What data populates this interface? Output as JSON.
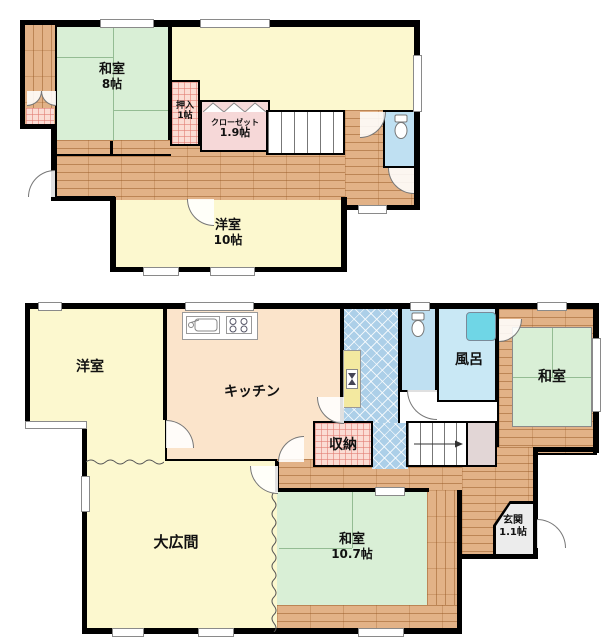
{
  "document_type": "floor-plan",
  "colors": {
    "wall": "#000000",
    "tatami_green": "#d9efd6",
    "western_room_yellow": "#fcf8cf",
    "kitchen_peach": "#fbe4cb",
    "wood_floor": "#e2b287",
    "closet_pink": "#f6d8d8",
    "closet_hatch_pink": "#fbdcd4",
    "toilet_blue": "#bfe0f2",
    "bath_blue": "#c9e8f5",
    "washroom_tile_blue": "#accfe8",
    "bathtub_cyan": "#6fd6e6",
    "entrance_grey": "#ececec",
    "understairs_grey": "#e2d6d6"
  },
  "floor1": {
    "rooms": {
      "washitsu8": {
        "name": "和室",
        "size": "8帖"
      },
      "oshiire": {
        "name": "押入",
        "size": "1帖"
      },
      "closet": {
        "name": "クローゼット",
        "size": "1.9帖"
      },
      "youshitsu10": {
        "name": "洋室",
        "size": "10帖"
      }
    },
    "icons": [
      "toilet-icon",
      "staircase",
      "balcony-doors",
      "accordion-door"
    ]
  },
  "floor2": {
    "rooms": {
      "youshitsu": {
        "name": "洋室"
      },
      "kitchen": {
        "name": "キッチン"
      },
      "bath": {
        "name": "風呂"
      },
      "washitsu": {
        "name": "和室"
      },
      "shuunou": {
        "name": "収納"
      },
      "ohiroma": {
        "name": "大広間"
      },
      "washitsu107": {
        "name": "和室",
        "size": "10.7帖"
      },
      "genkan": {
        "name": "玄関",
        "size": "1.1帖"
      }
    },
    "icons": [
      "kitchen-sink-icon",
      "stove-icon",
      "toilet-icon",
      "bathtub-icon",
      "washbasin-icon",
      "staircase-arrow"
    ]
  }
}
